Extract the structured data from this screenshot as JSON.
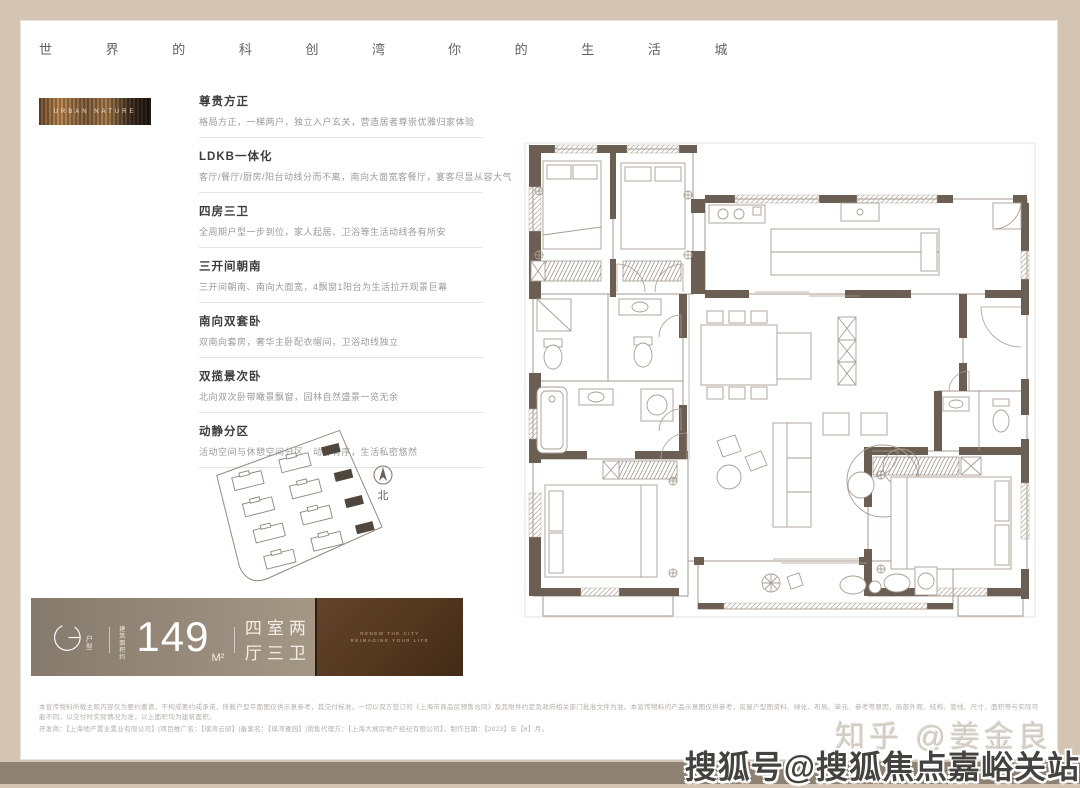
{
  "colors": {
    "frame": "#d4c4b3",
    "frame_bottom": "#8d8174",
    "card": "#ffffff",
    "wall": "#6b5e52",
    "banner_gradient_left": "#857a6c",
    "banner_gradient_right": "#a49786",
    "banner_photo": "#53371f",
    "accent_text": "#3c3c3c"
  },
  "header": {
    "phrase_left": "世 界 的 科 创 湾",
    "phrase_right": "你 的 生 活 城"
  },
  "thumbnail": {
    "label": "URBAN NATURE"
  },
  "features": [
    {
      "title": "尊贵方正",
      "desc": "格局方正，一梯两户，独立入户玄关，营造居者尊崇优雅归家体验"
    },
    {
      "title": "LDKB一体化",
      "desc": "客厅/餐厅/厨房/阳台动线分而不离，南向大面宽客餐厅，宴客尽显从容大气"
    },
    {
      "title": "四房三卫",
      "desc": "全周期户型一步到位，家人起居、卫浴等生活动线各有所安"
    },
    {
      "title": "三开间朝南",
      "desc": "三开间朝南、南向大面宽，4飘窗1阳台为生活拉开观景巨幕"
    },
    {
      "title": "南向双套卧",
      "desc": "双南向套房，奢华主卧配衣帽间，卫浴动线独立"
    },
    {
      "title": "双揽景次卧",
      "desc": "北向双次卧带瞰景飘窗，园林自然盛景一览无余"
    },
    {
      "title": "动静分区",
      "desc": "活动空间与休憩空间分区，动静有序，生活私密悠然"
    }
  ],
  "siteplan": {
    "north_label": "北"
  },
  "type_banner": {
    "letter": "G",
    "letter_label_1": "户",
    "letter_label_2": "型",
    "area_prefix_1": "建筑",
    "area_prefix_2": "面积约",
    "area_value": "149",
    "area_unit": "M²",
    "layout": "四室两厅三卫",
    "photo_line1": "RENEW THE CITY",
    "photo_line2": "REIMAGINE YOUR LIFE"
  },
  "disclaimer": {
    "line1": "本宣传物料所载主观内容仅为要约邀请，不构成要约或承诺，所载户型平面图仅供示意参考，其交付标准，一切以双方签订的《上海市商品房预售合同》及其附件约定及政府相关部门批准文件为准。本宣传物料的产品示意图仅供参考，房屋户型图资料、绿化、布局、单元、参考等原因，局部外观、结构、管线、尺寸、面积等与实际可能不同，以交付时实际情况为准，以上面积均为建筑面积。",
    "line2": "开发商：【上海地产置业置业有限公司】|项目推广名：【璞湾云邸】|备案名：【璞湾雅园】|销售代理方：【上海大展房地产经纪有限公司】，制作日期：【2023】年【6】月。"
  },
  "watermarks": {
    "zhihu": "知乎 @姜金良",
    "sohu": "搜狐号@搜狐焦点嘉峪关站"
  }
}
